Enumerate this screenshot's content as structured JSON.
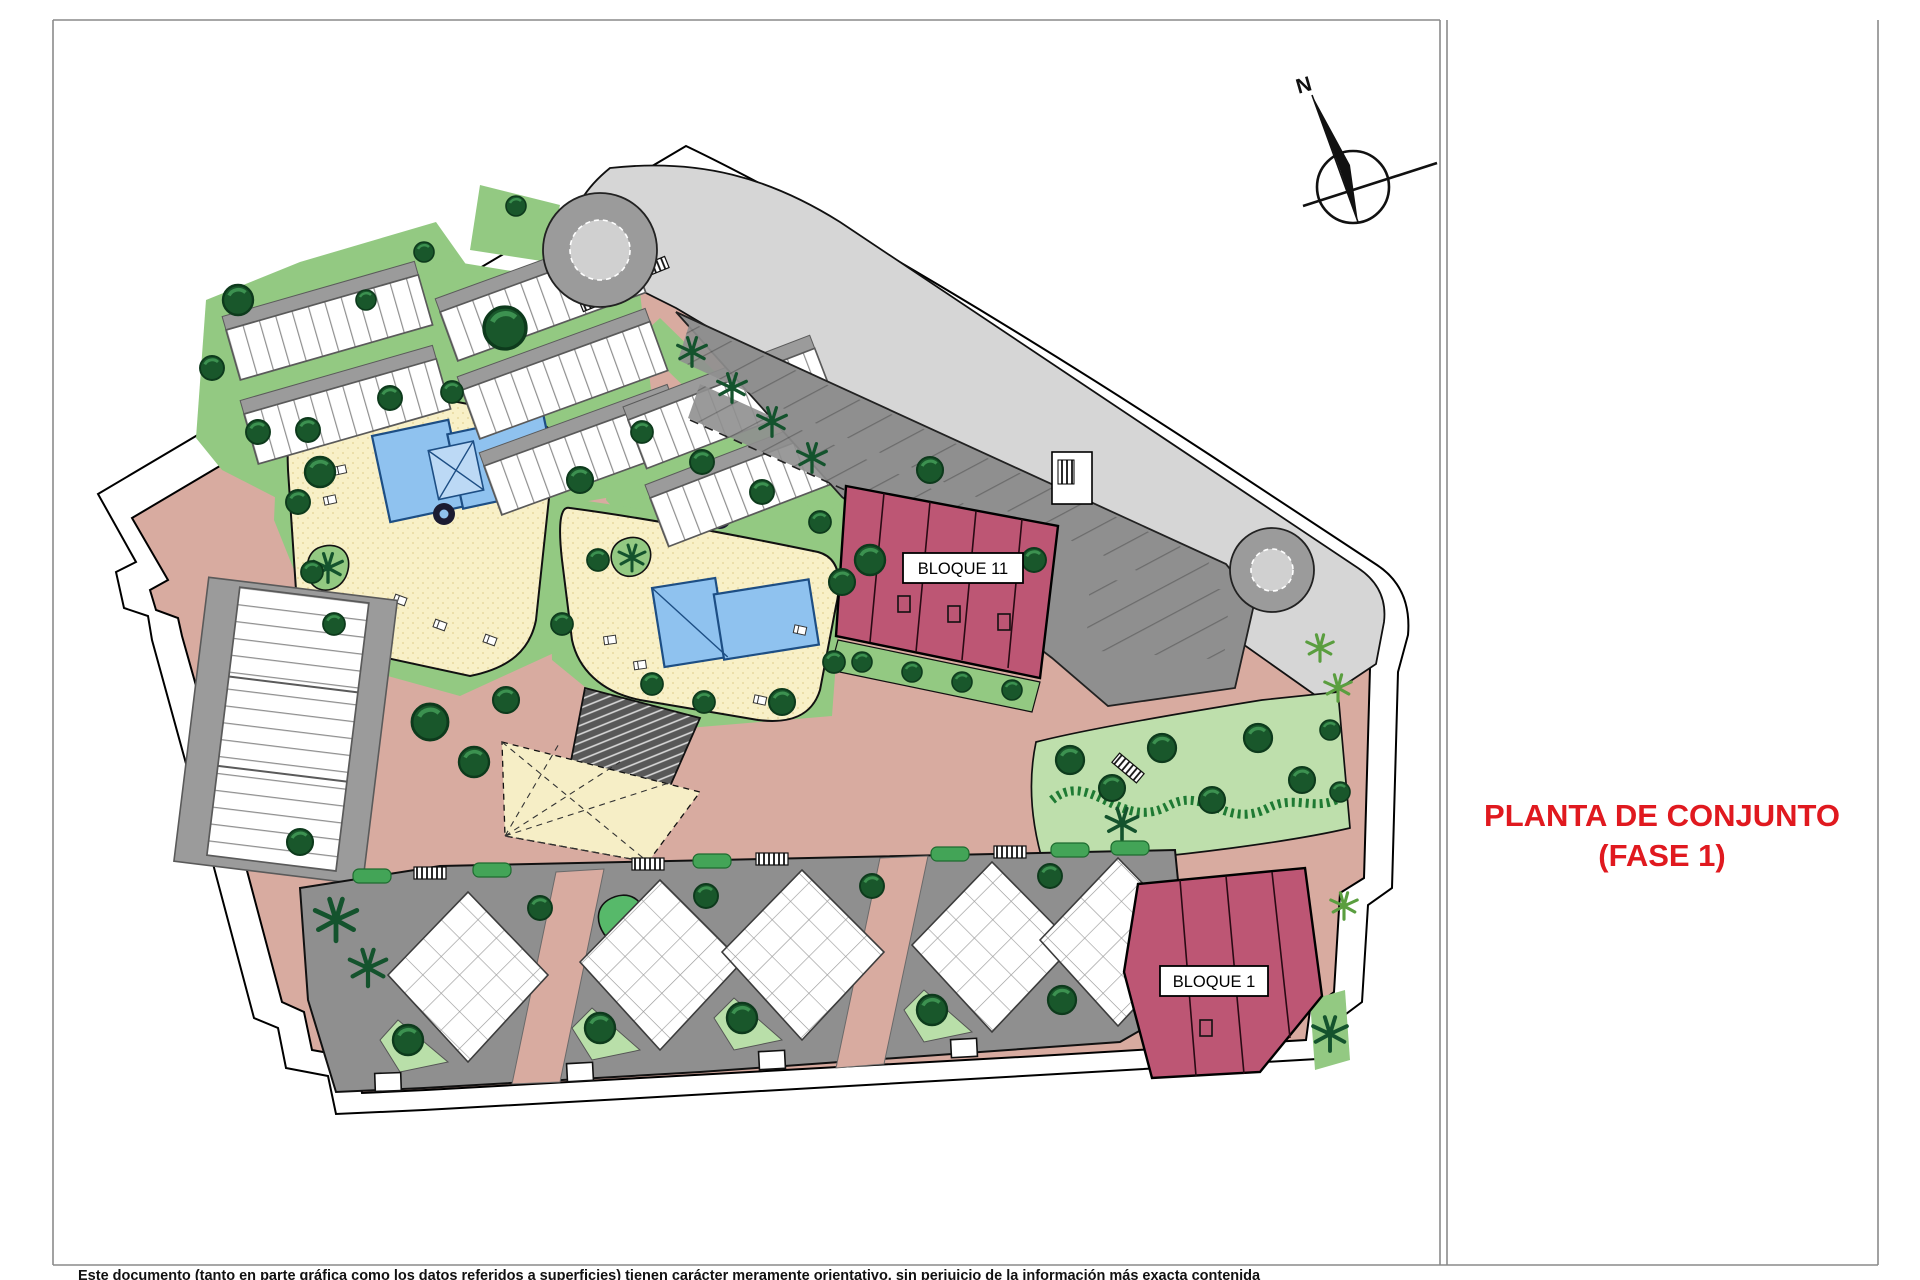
{
  "page": {
    "width": 1920,
    "height": 1280,
    "background": "#ffffff",
    "frame_color": "#8a8a8a"
  },
  "title_block": {
    "line1": "PLANTA DE CONJUNTO",
    "line2": "(FASE 1)",
    "text_color": "#e0191f"
  },
  "compass": {
    "north_label": "N"
  },
  "plan": {
    "block_labels": [
      {
        "id": "bloque-11",
        "text": "BLOQUE 11"
      },
      {
        "id": "bloque-1",
        "text": "BLOQUE 1"
      }
    ],
    "legend_colors": {
      "road_paving_pink": "#d8aba0",
      "lawn_green": "#93c982",
      "park_light_green": "#bedfac",
      "tree_dark_green": "#19572b",
      "hedge_green": "#43a457",
      "pool_water_blue": "#8fc2ef",
      "pool_deck_cream": "#f8f0c7",
      "parking_asphalt_gray": "#8f8f8f",
      "road_light_gray": "#d6d6d6",
      "phase_building_maroon": "#bd5674",
      "building_white": "#ffffff"
    }
  },
  "footer": {
    "disclaimer": "Este documento (tanto en parte gráfica como los datos referidos a superficies) tienen carácter meramente orientativo, sin perjuicio de la información más exacta contenida"
  }
}
